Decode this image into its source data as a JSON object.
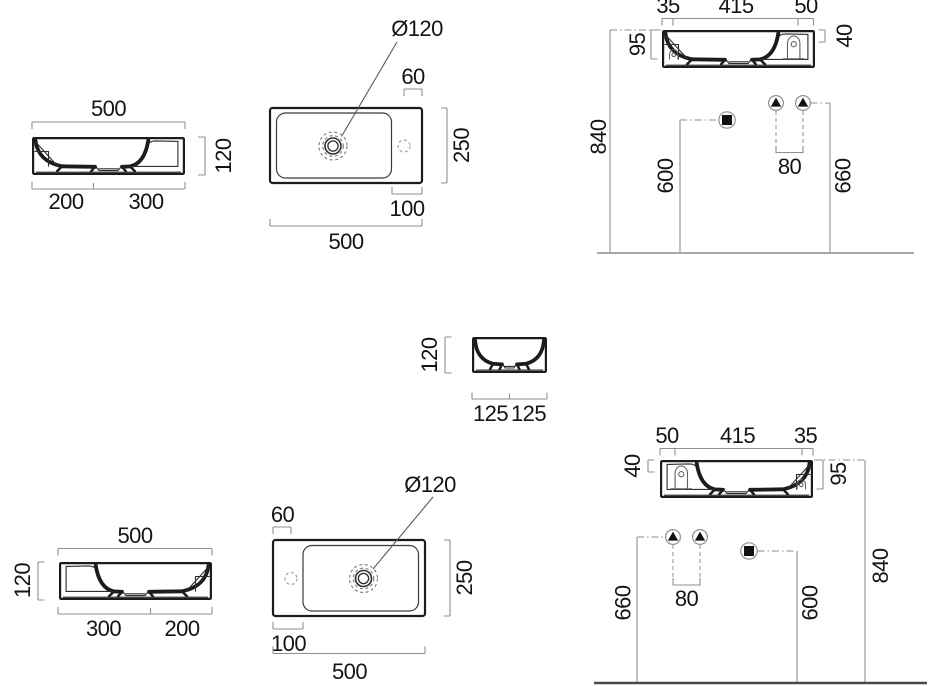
{
  "drawing_title": "Washbasin dimensional drawing (left-hand and right-hand tap deck versions)",
  "views": {
    "front_a": {
      "width": "500",
      "height": "120",
      "seg1": "200",
      "seg2": "300"
    },
    "plan_a": {
      "drain_diameter": "Ø120",
      "tap_offset": "60",
      "depth": "250",
      "deck_width": "100",
      "width": "500"
    },
    "install_a": {
      "wall_gap": "35",
      "bowl_span": "415",
      "deck_span": "50",
      "front_depth": "95",
      "rim_drop": "40",
      "rim_height": "840",
      "drain_height": "600",
      "supply_spacing": "80",
      "supply_height": "660"
    },
    "side": {
      "height": "120",
      "seg1": "125",
      "seg2": "125"
    },
    "front_b": {
      "width": "500",
      "height": "120",
      "seg1": "300",
      "seg2": "200"
    },
    "plan_b": {
      "tap_offset": "60",
      "drain_diameter": "Ø120",
      "depth": "250",
      "deck_width": "100",
      "width": "500"
    },
    "install_b": {
      "deck_span": "50",
      "bowl_span": "415",
      "wall_gap": "35",
      "rim_drop": "40",
      "front_depth": "95",
      "supply_height": "660",
      "supply_spacing": "80",
      "drain_height": "600",
      "rim_height": "840"
    }
  }
}
